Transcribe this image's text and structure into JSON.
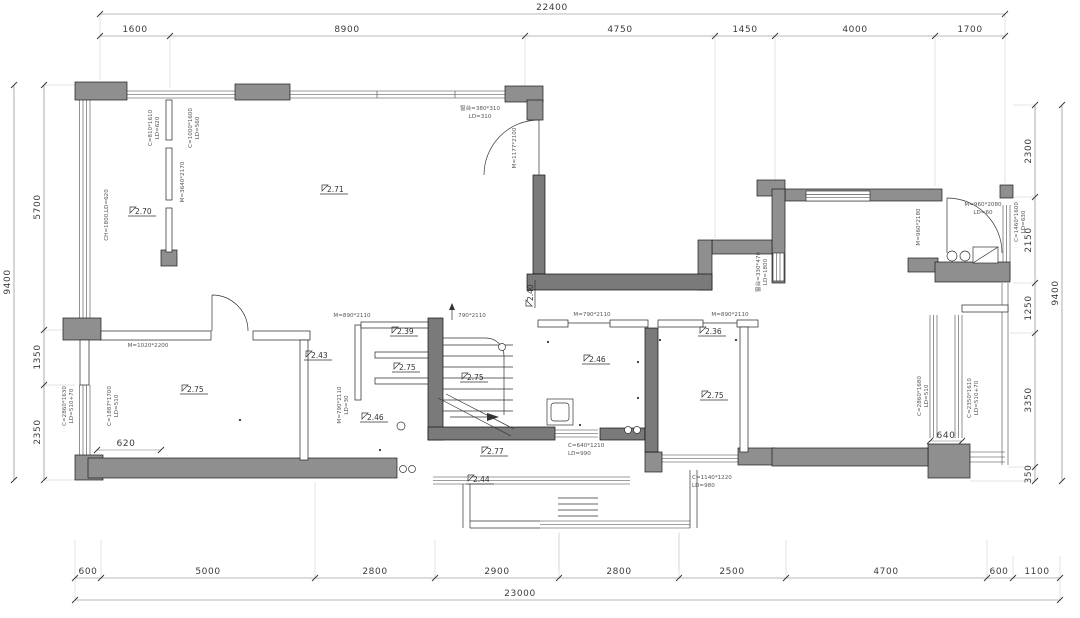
{
  "plan": {
    "dims": {
      "top": {
        "overall": "22400",
        "segs": [
          "1600",
          "8900",
          "4750",
          "1450",
          "4000",
          "1700"
        ]
      },
      "bottom": {
        "overall": "23000",
        "segs": [
          "600",
          "5000",
          "2800",
          "2900",
          "2800",
          "2500",
          "4700",
          "600",
          "1100"
        ]
      },
      "left": {
        "overall": "9400",
        "segs": [
          "5700",
          "1350",
          "2350"
        ]
      },
      "right": {
        "overall": "9400",
        "segs": [
          "2300",
          "2150",
          "1250",
          "3350",
          "350"
        ]
      },
      "inline": {
        "d620": "620",
        "d640": "640"
      }
    },
    "levels": {
      "l271": "2.71",
      "l270": "2.70",
      "l243": "2.43",
      "l239": "2.39",
      "l275a": "2.75",
      "l275b": "2.75",
      "l246a": "2.46",
      "l240": "2.40",
      "l246b": "2.46",
      "l277": "2.77",
      "l244": "2.44",
      "l236": "2.36",
      "l275c": "2.75",
      "l275d": "2.75"
    },
    "openings": {
      "c810": [
        "C=810*1610",
        "LD=620"
      ],
      "c1000": [
        "C=1000*1600",
        "LD=560"
      ],
      "m3640": [
        "M=3640*2170"
      ],
      "ch1800": [
        "CH=1800,LD=620"
      ],
      "win380": [
        "窗台=380*310",
        "LD=310"
      ],
      "m1177": [
        "M=1177*2100"
      ],
      "m1020": [
        "M=1020*2200"
      ],
      "c1887": [
        "C=1887*1700",
        "LD=510"
      ],
      "c2860a": [
        "C=2860*1630",
        "LD=510+70"
      ],
      "m890a": [
        "M=890*2110"
      ],
      "up790": [
        "790*2110"
      ],
      "m790v": [
        "M=790*2110",
        "LD=30"
      ],
      "m790b": [
        "M=790*2110"
      ],
      "m890b": [
        "M=890*2110"
      ],
      "c640": [
        "C=640*1210",
        "LD=990"
      ],
      "c1140": [
        "C=1140*1220",
        "LD=980"
      ],
      "sill330": [
        "窗台=330*470",
        "LD=1800"
      ],
      "m960v": [
        "M=960*2180"
      ],
      "m960": [
        "M=960*2080",
        "LD=60"
      ],
      "c1460": [
        "C=1460*1600",
        "LD=630"
      ],
      "c2860b": [
        "C=2860*1680",
        "LD=510"
      ],
      "c2350": [
        "C=2350*1610",
        "LD=510+70"
      ]
    }
  }
}
